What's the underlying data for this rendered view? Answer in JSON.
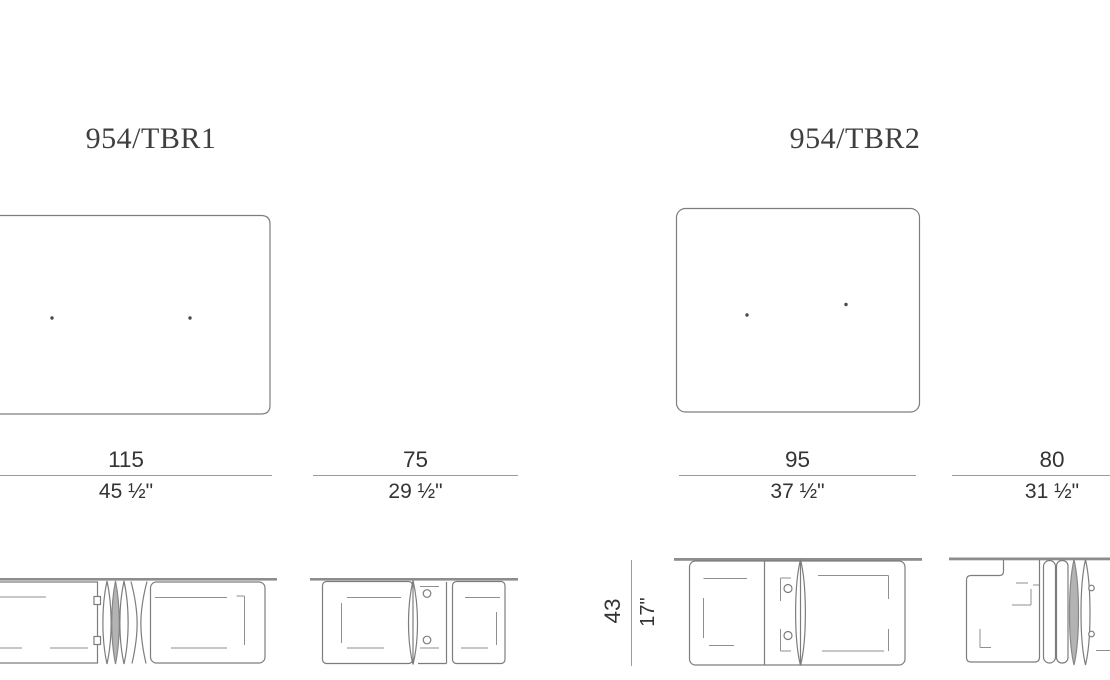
{
  "page": {
    "background": "#ffffff"
  },
  "colors": {
    "drawing_line": "#7d7d7d",
    "dimension_line": "#9b9b9b",
    "text": "#333333",
    "leaf_fill": "#b3b3b3"
  },
  "models": [
    {
      "name": "954/TBR1",
      "width": {
        "cm": "115",
        "inch": "45 ½\""
      },
      "depth": {
        "cm": "75",
        "inch": "29 ½\""
      }
    },
    {
      "name": "954/TBR2",
      "width": {
        "cm": "95",
        "inch": "37 ½\""
      },
      "depth": {
        "cm": "80",
        "inch": "31 ½\""
      },
      "height": {
        "cm": "43",
        "inch": "17\""
      }
    }
  ]
}
